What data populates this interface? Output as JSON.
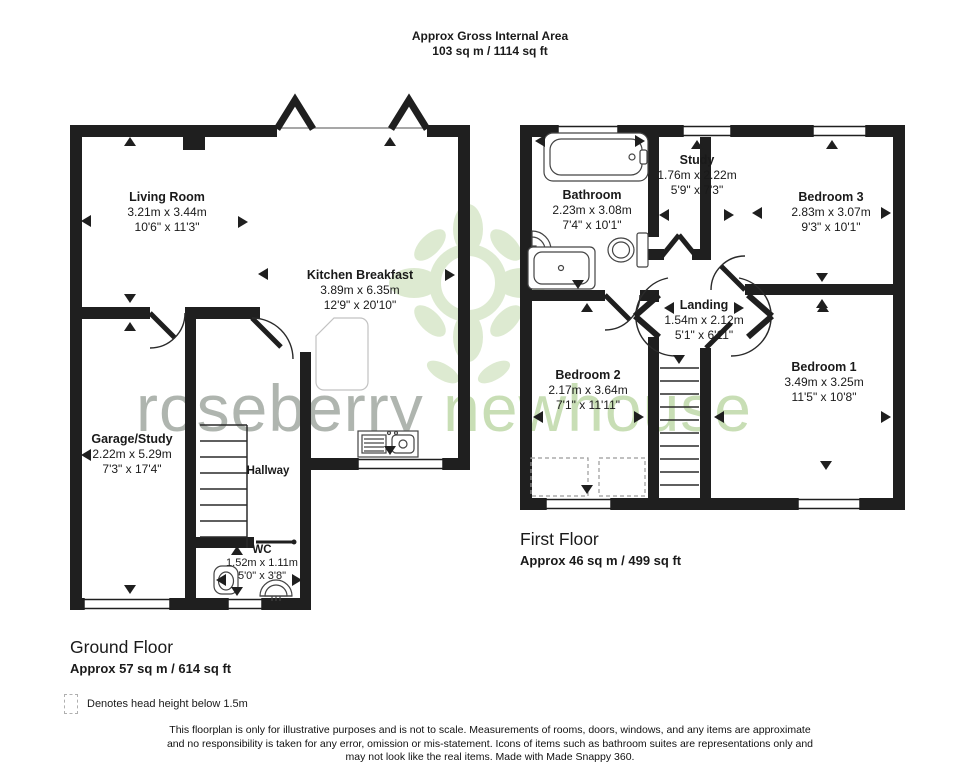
{
  "header": {
    "title": "Approx Gross Internal Area",
    "subtitle": "103 sq m / 1114 sq ft"
  },
  "watermark": {
    "word1": "roseberry",
    "word2": "newhouse",
    "logo_color": "#d8e7ca"
  },
  "colors": {
    "wall": "#1f1f1f",
    "tread": "#2a2a2a",
    "fixture_outline": "#444444"
  },
  "ground_floor": {
    "title": "Ground Floor",
    "area": "Approx 57 sq m / 614 sq ft",
    "rooms": {
      "living_room": {
        "name": "Living Room",
        "metric": "3.21m x 3.44m",
        "imperial": "10'6\" x 11'3\""
      },
      "kitchen": {
        "name": "Kitchen Breakfast",
        "metric": "3.89m x 6.35m",
        "imperial": "12'9\" x 20'10\""
      },
      "garage": {
        "name": "Garage/Study",
        "metric": "2.22m x 5.29m",
        "imperial": "7'3\" x 17'4\""
      },
      "hallway": {
        "name": "Hallway"
      },
      "wc": {
        "name": "WC",
        "metric": "1.52m x 1.11m",
        "imperial": "5'0\" x 3'8\""
      }
    }
  },
  "first_floor": {
    "title": "First Floor",
    "area": "Approx 46 sq m / 499 sq ft",
    "rooms": {
      "bathroom": {
        "name": "Bathroom",
        "metric": "2.23m x 3.08m",
        "imperial": "7'4\" x 10'1\""
      },
      "study": {
        "name": "Study",
        "metric": "1.76m x 2.22m",
        "imperial": "5'9\" x 7'3\""
      },
      "bedroom3": {
        "name": "Bedroom 3",
        "metric": "2.83m x 3.07m",
        "imperial": "9'3\" x 10'1\""
      },
      "landing": {
        "name": "Landing",
        "metric": "1.54m x 2.12m",
        "imperial": "5'1\" x 6'11\""
      },
      "bedroom2": {
        "name": "Bedroom 2",
        "metric": "2.17m x 3.64m",
        "imperial": "7'1\" x 11'11\""
      },
      "bedroom1": {
        "name": "Bedroom 1",
        "metric": "3.49m x 3.25m",
        "imperial": "11'5\" x 10'8\""
      }
    }
  },
  "legend": {
    "label": "Denotes head height below 1.5m"
  },
  "disclaimer": {
    "line1": "This floorplan is only for illustrative purposes and is not to scale. Measurements of rooms, doors, windows, and any items are approximate",
    "line2": "and no responsibility is taken for any error, omission or mis-statement. Icons of items such as bathroom suites are representations only and",
    "line3": "may not look like the real items. Made with Made Snappy 360."
  }
}
